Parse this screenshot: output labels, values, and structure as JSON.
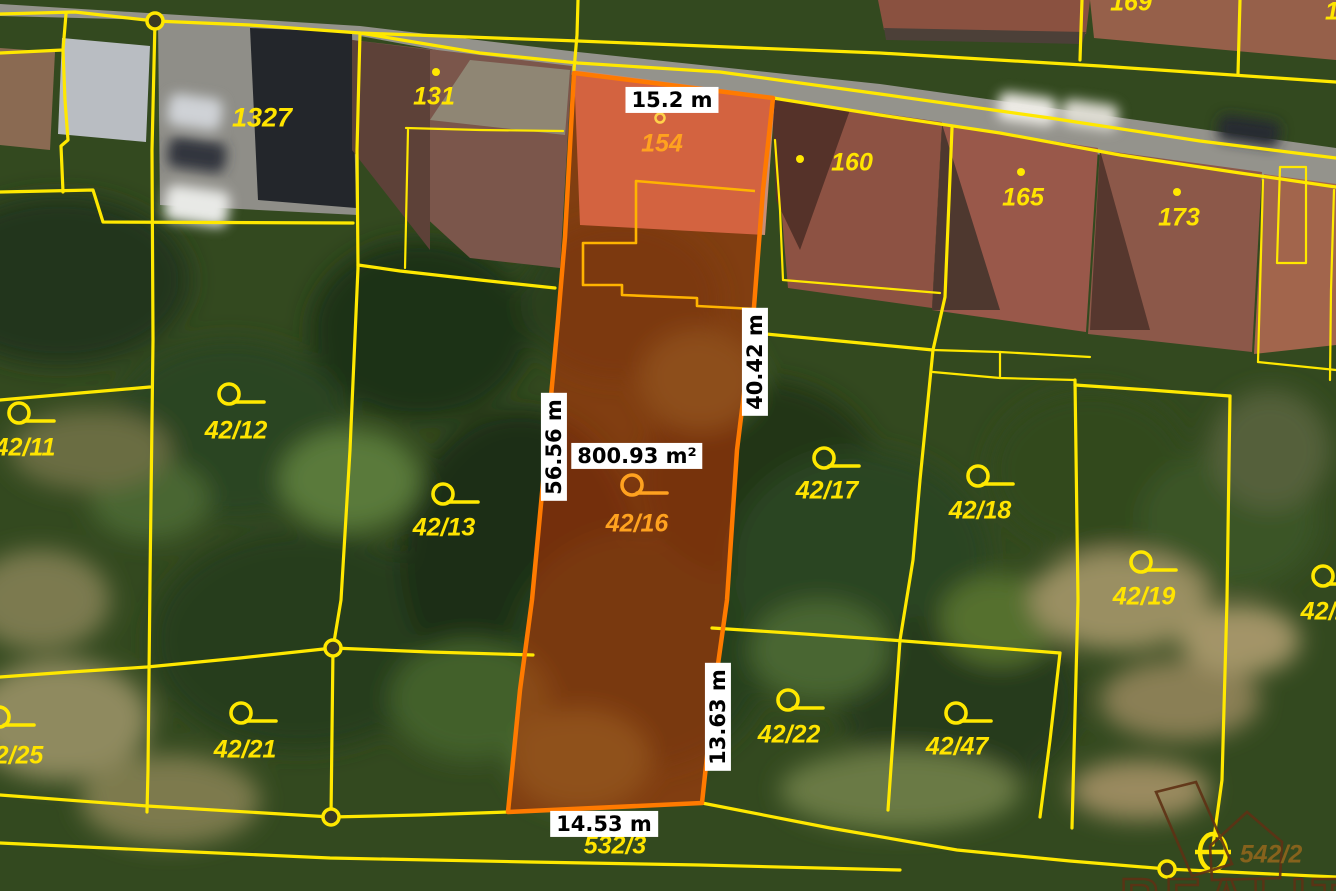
{
  "highlight": {
    "parcel": "42/16",
    "area": "800.93 m²",
    "width_top": "15.2 m",
    "length_left": "56.56 m",
    "length_right_upper": "40.42 m",
    "length_right_lower": "13.63 m",
    "width_bottom": "14.53 m"
  },
  "parcels": {
    "p1327": "1327",
    "p131": "131",
    "p154": "154",
    "p160": "160",
    "p165": "165",
    "p169": "169",
    "p173": "173",
    "p1_partial": "1",
    "p42_11": "42/11",
    "p42_12": "42/12",
    "p42_13": "42/13",
    "p42_16": "42/16",
    "p42_17": "42/17",
    "p42_18": "42/18",
    "p42_19": "42/19",
    "p42_21": "42/21",
    "p42_22": "42/22",
    "p42_25": "42/25",
    "p42_47": "42/47",
    "p42_2_partial": "42/2",
    "p532_3": "532/3",
    "p542_2": "542/2"
  },
  "watermark": {
    "text": "REALITY"
  },
  "colors": {
    "cadastral_line": "#ffe800",
    "highlight_outline": "#ff7a00",
    "highlight_fill": "#e03000",
    "inner_division_line": "#ffb400",
    "label_yellow": "#ffe400",
    "label_orange": "#ffa21f",
    "label_dark_olive": "#86621c",
    "watermark_brown": "#5f3114"
  }
}
